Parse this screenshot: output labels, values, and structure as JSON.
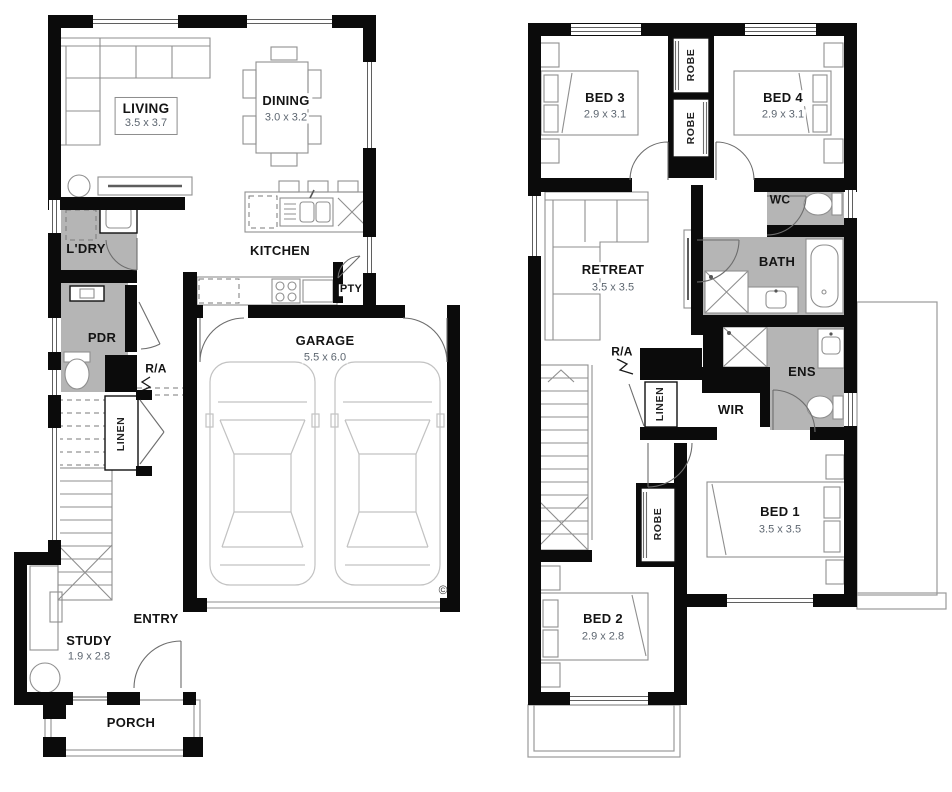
{
  "document": {
    "type": "house-floor-plan",
    "floor_count": 2
  },
  "colors": {
    "wall": "#0b0b0b",
    "wet_area": "#b5b5b5",
    "furniture_line": "#8f8f8f",
    "label": "#141414",
    "dims": "#5d6670"
  },
  "ground_floor": {
    "rooms": [
      {
        "id": "living",
        "label": "LIVING",
        "dims": "3.5 x 3.7"
      },
      {
        "id": "dining",
        "label": "DINING",
        "dims": "3.0 x 3.2"
      },
      {
        "id": "kitchen",
        "label": "KITCHEN",
        "dims": ""
      },
      {
        "id": "pty",
        "label": "PTY",
        "dims": ""
      },
      {
        "id": "ldry",
        "label": "L'DRY",
        "dims": ""
      },
      {
        "id": "pdr",
        "label": "PDR",
        "dims": ""
      },
      {
        "id": "ra",
        "label": "R/A",
        "dims": ""
      },
      {
        "id": "linen",
        "label": "LINEN",
        "dims": ""
      },
      {
        "id": "garage",
        "label": "GARAGE",
        "dims": "5.5 x 6.0"
      },
      {
        "id": "study",
        "label": "STUDY",
        "dims": "1.9 x 2.8"
      },
      {
        "id": "entry",
        "label": "ENTRY",
        "dims": ""
      },
      {
        "id": "porch",
        "label": "PORCH",
        "dims": ""
      }
    ],
    "copyright_mark": "©"
  },
  "upper_floor": {
    "rooms": [
      {
        "id": "bed3",
        "label": "BED 3",
        "dims": "2.9 x 3.1"
      },
      {
        "id": "bed4",
        "label": "BED 4",
        "dims": "2.9 x 3.1"
      },
      {
        "id": "robe_a",
        "label": "ROBE",
        "dims": ""
      },
      {
        "id": "robe_b",
        "label": "ROBE",
        "dims": ""
      },
      {
        "id": "wc",
        "label": "WC",
        "dims": ""
      },
      {
        "id": "retreat",
        "label": "RETREAT",
        "dims": "3.5 x 3.5"
      },
      {
        "id": "bath",
        "label": "BATH",
        "dims": ""
      },
      {
        "id": "ra",
        "label": "R/A",
        "dims": ""
      },
      {
        "id": "linen",
        "label": "LINEN",
        "dims": ""
      },
      {
        "id": "wir",
        "label": "WIR",
        "dims": ""
      },
      {
        "id": "ens",
        "label": "ENS",
        "dims": ""
      },
      {
        "id": "bed1",
        "label": "BED 1",
        "dims": "3.5 x 3.5"
      },
      {
        "id": "robe_c",
        "label": "ROBE",
        "dims": ""
      },
      {
        "id": "bed2",
        "label": "BED 2",
        "dims": "2.9 x 2.8"
      }
    ]
  }
}
